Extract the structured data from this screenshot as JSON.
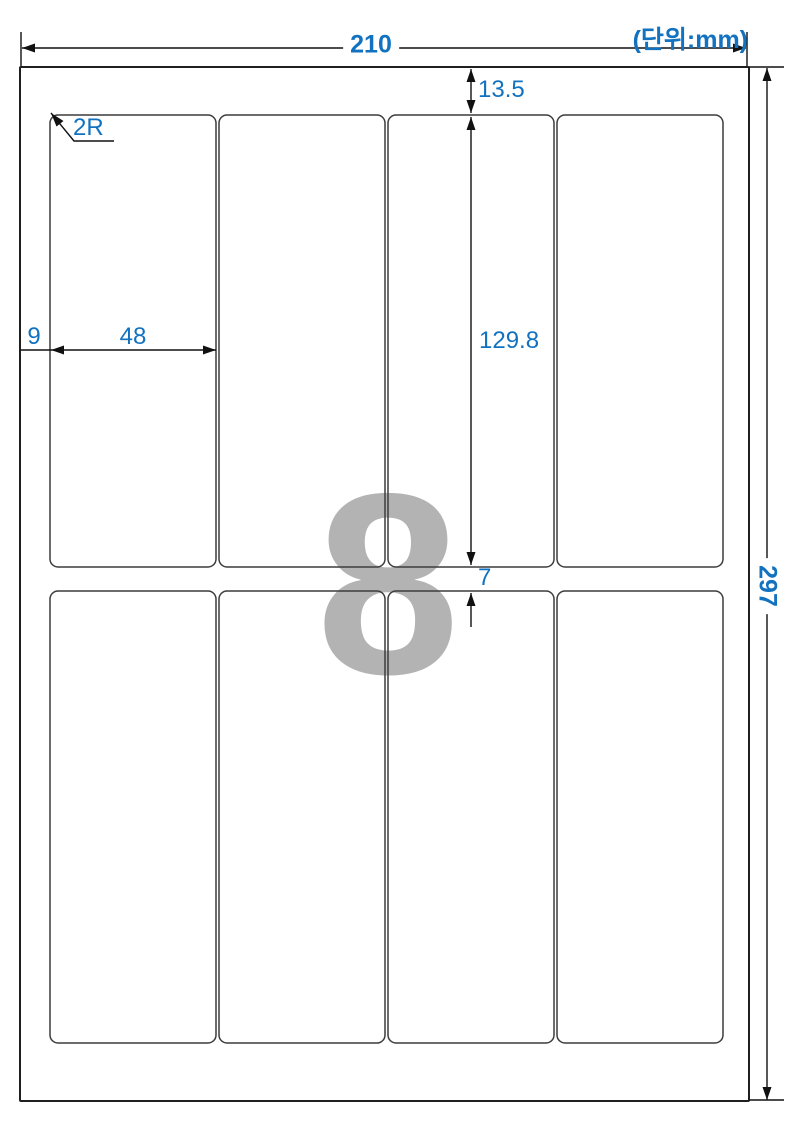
{
  "unit_note": "(단위:mm)",
  "sheet": {
    "width_mm": "210",
    "height_mm": "297",
    "top_margin_mm": "13.5",
    "left_margin_mm": "9",
    "label_width_mm": "48",
    "label_height_mm": "129.8",
    "row_gap_mm": "7",
    "corner_radius": "2R",
    "labels_per_sheet": "8",
    "columns": 4,
    "rows": 2
  },
  "colors": {
    "dimension_text_blue": "#1272bf",
    "watermark_gray": "#b3b3b3",
    "line_black": "#1a1a1a"
  }
}
